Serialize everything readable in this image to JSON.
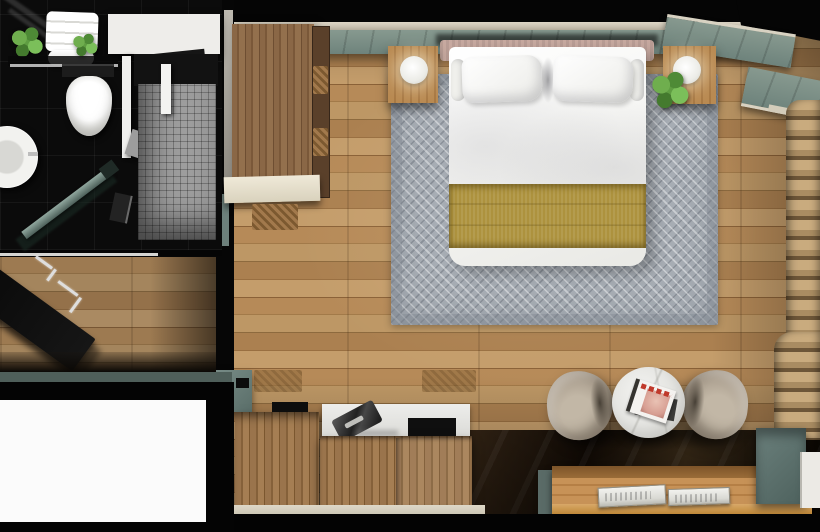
{
  "meta": {
    "title": "Hotel room top-down 3D floor plan render",
    "view": "top-down",
    "image_width": 820,
    "image_height": 532
  },
  "palette": {
    "wall_black": "#060606",
    "accent_teal": "#7a918a",
    "trim_cream": "#d8d2c2",
    "floor_wood": "#ad8354",
    "floor_wood_light": "#c09a6a",
    "floor_wood_dark": "#8d6a3e",
    "rug_gray": "#a8aeb5",
    "bed_white": "#f6f6f4",
    "runner_gold": "#ad923e",
    "headboard_blush": "#c7a9a0",
    "chair_taupe": "#aca091",
    "curtain_beige": "#bb9e74",
    "cabinet_slate": "#5e7471",
    "marble_white": "#e9e9e7",
    "shower_tile_gray": "#9c9c9c",
    "desk_wood": "#c79257",
    "bathroom_tile_black": "#0b0b0b"
  },
  "rooms": {
    "bathroom": {
      "label": "Bathroom",
      "items": [
        {
          "id": "vanity",
          "label": "Vanity counter"
        },
        {
          "id": "towel-shelf",
          "label": "Towel shelf with plants"
        },
        {
          "id": "toilet",
          "label": "Toilet"
        },
        {
          "id": "sink",
          "label": "Round basin sink"
        },
        {
          "id": "shower",
          "label": "Walk-in shower"
        },
        {
          "id": "shower-door",
          "label": "Glass shower door"
        },
        {
          "id": "mosaic",
          "label": "Grey mosaic shower tiles",
          "color": "#9c9c9c"
        }
      ]
    },
    "entry": {
      "label": "Entry hallway",
      "items": [
        {
          "id": "entry-door",
          "label": "Open entry door"
        },
        {
          "id": "entry-floor",
          "label": "Entry wood floor"
        }
      ]
    },
    "bedroom": {
      "label": "Bedroom",
      "items": [
        {
          "id": "wardrobe",
          "label": "Wardrobe"
        },
        {
          "id": "luggage-shelf",
          "label": "Luggage shelf"
        },
        {
          "id": "bed",
          "label": "Double bed with white linens"
        },
        {
          "id": "bed-runner",
          "label": "Gold bed runner",
          "color": "#ad923e"
        },
        {
          "id": "headboard",
          "label": "Upholstered headboard",
          "color": "#c7a9a0"
        },
        {
          "id": "nightstand-left",
          "label": "Left nightstand with globe lamp"
        },
        {
          "id": "nightstand-right",
          "label": "Right nightstand with globe lamp"
        },
        {
          "id": "plant",
          "label": "Potted plant"
        },
        {
          "id": "rug",
          "label": "Grey patterned area rug",
          "color": "#a8aeb5"
        },
        {
          "id": "accent-wall",
          "label": "Teal plank accent wall",
          "color": "#7a918a"
        },
        {
          "id": "curtains",
          "label": "Beige curtains",
          "color": "#bb9e74"
        },
        {
          "id": "tv",
          "label": "Television"
        },
        {
          "id": "tv-credenza",
          "label": "TV credenza"
        },
        {
          "id": "minibar-cabinet",
          "label": "Minibar cabinet"
        },
        {
          "id": "armchair-left",
          "label": "Left armchair",
          "color": "#aca091"
        },
        {
          "id": "armchair-right",
          "label": "Right armchair",
          "color": "#aca091"
        },
        {
          "id": "coffee-table",
          "label": "Round marble side table"
        },
        {
          "id": "magazine",
          "label": "Magazine"
        },
        {
          "id": "desk",
          "label": "Window-side desk"
        },
        {
          "id": "books",
          "label": "Books on desk"
        },
        {
          "id": "side-cabinet",
          "label": "Slate side cabinet",
          "color": "#5e7471"
        },
        {
          "id": "luggage-bench",
          "label": "Woven basket"
        }
      ]
    }
  }
}
